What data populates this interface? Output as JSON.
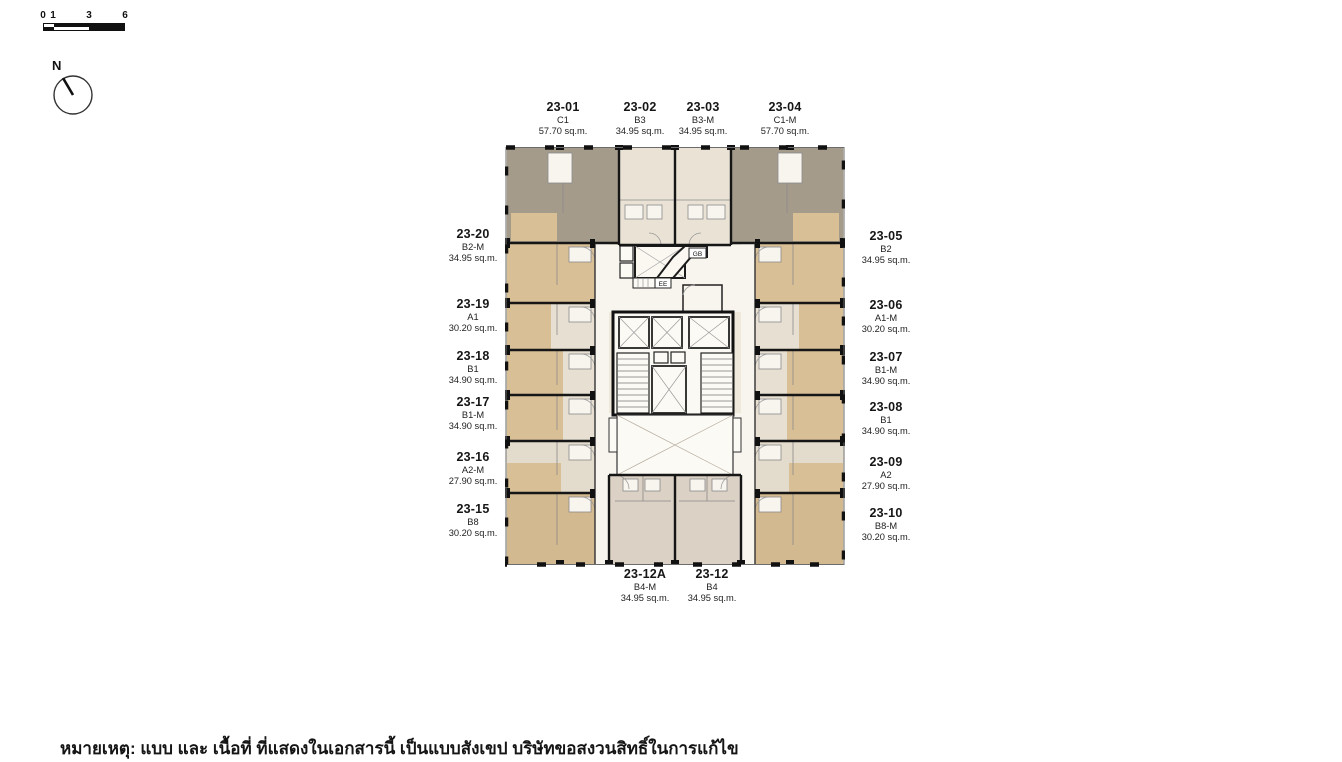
{
  "scale_bar": {
    "tick_0": "0",
    "tick_1": "1",
    "tick_3": "3",
    "tick_6": "6"
  },
  "compass": {
    "north_label": "N"
  },
  "floor_plan": {
    "gb_label": "GB",
    "ee_label": "EE"
  },
  "units": {
    "top": [
      {
        "id": "23-01",
        "type": "C1",
        "area": "57.70 sq.m."
      },
      {
        "id": "23-02",
        "type": "B3",
        "area": "34.95 sq.m."
      },
      {
        "id": "23-03",
        "type": "B3-M",
        "area": "34.95 sq.m."
      },
      {
        "id": "23-04",
        "type": "C1-M",
        "area": "57.70 sq.m."
      }
    ],
    "right": [
      {
        "id": "23-05",
        "type": "B2",
        "area": "34.95 sq.m."
      },
      {
        "id": "23-06",
        "type": "A1-M",
        "area": "30.20 sq.m."
      },
      {
        "id": "23-07",
        "type": "B1-M",
        "area": "34.90 sq.m."
      },
      {
        "id": "23-08",
        "type": "B1",
        "area": "34.90 sq.m."
      },
      {
        "id": "23-09",
        "type": "A2",
        "area": "27.90 sq.m."
      },
      {
        "id": "23-10",
        "type": "B8-M",
        "area": "30.20 sq.m."
      }
    ],
    "left": [
      {
        "id": "23-20",
        "type": "B2-M",
        "area": "34.95 sq.m."
      },
      {
        "id": "23-19",
        "type": "A1",
        "area": "30.20 sq.m."
      },
      {
        "id": "23-18",
        "type": "B1",
        "area": "34.90 sq.m."
      },
      {
        "id": "23-17",
        "type": "B1-M",
        "area": "34.90 sq.m."
      },
      {
        "id": "23-16",
        "type": "A2-M",
        "area": "27.90 sq.m."
      },
      {
        "id": "23-15",
        "type": "B8",
        "area": "30.20 sq.m."
      }
    ],
    "bottom": [
      {
        "id": "23-12A",
        "type": "B4-M",
        "area": "34.95 sq.m."
      },
      {
        "id": "23-12",
        "type": "B4",
        "area": "34.95 sq.m."
      }
    ]
  },
  "note": "หมายเหตุ: แบบ และ เนื้อที่ ที่แสดงในเอกสารนี้ เป็นแบบสังเขป บริษัทขอสงวนสิทธิ์ในการแก้ไข",
  "colors": {
    "unit_grey": "#A59B8B",
    "unit_tan": "#D9BF96",
    "unit_cream": "#E7E0D2",
    "base": "#EFE9DC",
    "bottom_center": "#DBD1C4"
  }
}
